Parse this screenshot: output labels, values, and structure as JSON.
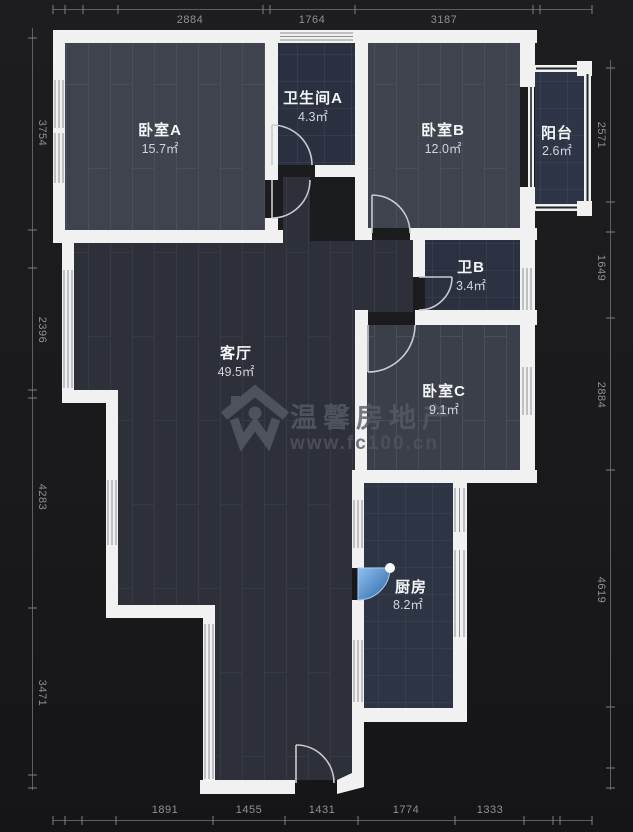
{
  "title": "户型图 (floor plan)",
  "watermark": {
    "brand": "温馨房地产",
    "url": "www.fc100.cn"
  },
  "rooms": [
    {
      "id": "bedroom-a",
      "name": "卧室A",
      "area": "15.7㎡",
      "floor": "wood"
    },
    {
      "id": "bath-a",
      "name": "卫生间A",
      "area": "4.3㎡",
      "floor": "tile"
    },
    {
      "id": "bedroom-b",
      "name": "卧室B",
      "area": "12.0㎡",
      "floor": "wood"
    },
    {
      "id": "balcony",
      "name": "阳台",
      "area": "2.6㎡",
      "floor": "tile"
    },
    {
      "id": "bath-b",
      "name": "卫B",
      "area": "3.4㎡",
      "floor": "tile"
    },
    {
      "id": "living",
      "name": "客厅",
      "area": "49.5㎡",
      "floor": "wood"
    },
    {
      "id": "bedroom-c",
      "name": "卧室C",
      "area": "9.1㎡",
      "floor": "wood"
    },
    {
      "id": "kitchen",
      "name": "厨房",
      "area": "8.2㎡",
      "floor": "tile"
    }
  ],
  "dimensions": {
    "top": [
      "2884",
      "1764",
      "3187"
    ],
    "bottom": [
      "1891",
      "1455",
      "1431",
      "1774",
      "1333"
    ],
    "left": [
      "3754",
      "2396",
      "4283",
      "3471"
    ],
    "right": [
      "2571",
      "1649",
      "2884",
      "4619"
    ]
  },
  "colors": {
    "background": "#1a1a1c",
    "wall": "#f1f1f1",
    "wood_floor": "#3f434d",
    "living_floor": "#2d3039",
    "tile_floor": "#2b3142",
    "door_highlight_blue": "#4a90d9",
    "dimension_text": "#8f9092",
    "watermark_gray": "#575b66"
  },
  "icons": {
    "watermark_house": "house-logo-icon",
    "door_handle": "door-handle-dot"
  }
}
